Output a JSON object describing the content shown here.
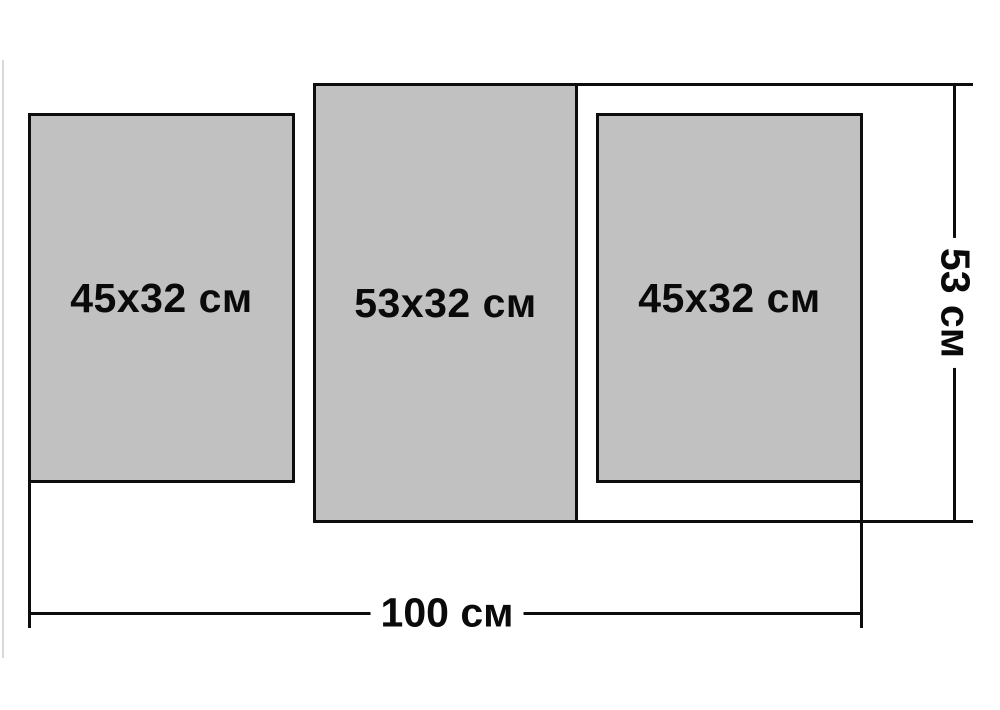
{
  "diagram": {
    "panels": [
      {
        "id": "left",
        "label": "45x32 см"
      },
      {
        "id": "middle",
        "label": "53x32 см"
      },
      {
        "id": "right",
        "label": "45x32 см"
      }
    ],
    "dimensions": {
      "total_width_label": "100 см",
      "total_height_label": "53 см"
    },
    "colors": {
      "panel_fill": "#c1c1c1",
      "line": "#0d0d0d",
      "background": "#ffffff"
    }
  }
}
